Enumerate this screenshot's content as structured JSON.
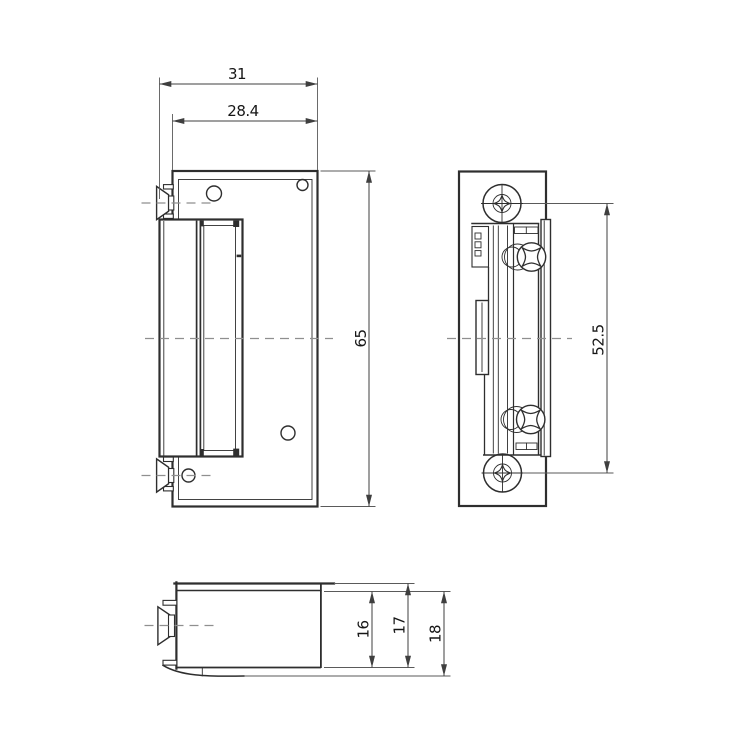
{
  "drawing": {
    "kind": "electric-door-strike-technical-drawing",
    "views": {
      "front": {
        "dims": {
          "width_overall": "31",
          "width_plate": "28.4",
          "height": "65"
        }
      },
      "side": {
        "dims": {
          "screw_spacing": "52.5"
        }
      },
      "bottom": {
        "dims": {
          "depth_body": "16",
          "depth_with_faceplate": "17",
          "depth_overall": "18"
        }
      }
    },
    "colors": {
      "object_line": "#2e2e2e",
      "dimension_line": "#3f3f3f",
      "centerline": "#8f8f8f",
      "background": "#ffffff"
    }
  }
}
